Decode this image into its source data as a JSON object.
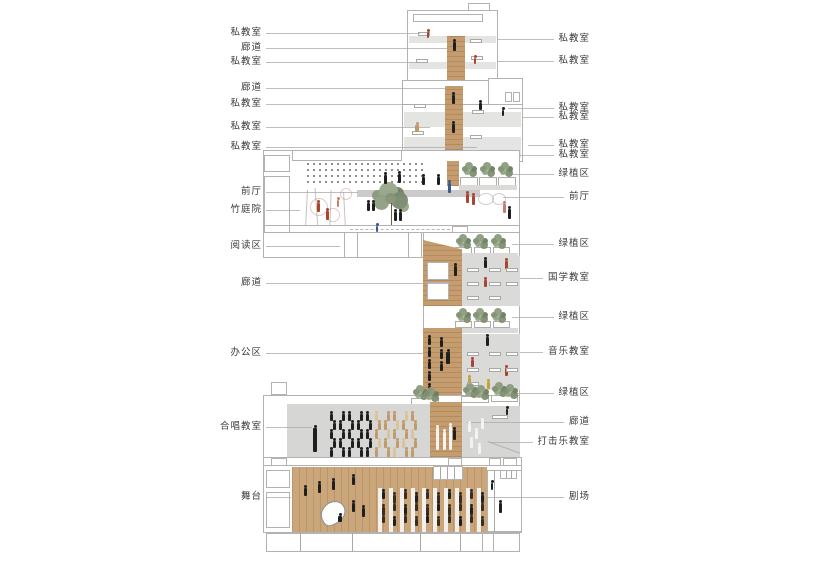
{
  "drawing": {
    "type": "architectural-section",
    "subject": "music school building section with room annotations"
  },
  "colors": {
    "wood": "#c59c6e",
    "room_gray": "#dadad9",
    "slab_gray": "#e4e4e3",
    "plant_green": "#7f9070",
    "outline": "#b3b2b0",
    "label_text": "#3b3b3b",
    "figure_red": "#a8452f",
    "figure_blue": "#3c5a8c",
    "figure_tan": "#c2996a"
  },
  "left_labels": [
    {
      "name": "private-classroom",
      "text": "私教室",
      "y": 33,
      "to": 420
    },
    {
      "name": "corridor",
      "text": "廊道",
      "y": 48,
      "to": 447
    },
    {
      "name": "private-classroom",
      "text": "私教室",
      "y": 62,
      "to": 420
    },
    {
      "name": "corridor",
      "text": "廊道",
      "y": 88,
      "to": 447
    },
    {
      "name": "private-classroom",
      "text": "私教室",
      "y": 104,
      "to": 418
    },
    {
      "name": "private-classroom",
      "text": "私教室",
      "y": 127,
      "to": 430
    },
    {
      "name": "private-classroom",
      "text": "私教室",
      "y": 147,
      "to": 477
    },
    {
      "name": "foyer",
      "text": "前厅",
      "y": 192,
      "to": 358
    },
    {
      "name": "bamboo-courtyard",
      "text": "竹庭院",
      "y": 210,
      "to": 300
    },
    {
      "name": "reading-area",
      "text": "阅读区",
      "y": 246,
      "to": 340
    },
    {
      "name": "corridor",
      "text": "廊道",
      "y": 283,
      "to": 455
    },
    {
      "name": "office-area",
      "text": "办公区",
      "y": 353,
      "to": 425
    },
    {
      "name": "choir-classroom",
      "text": "合唱教室",
      "y": 427,
      "to": 312
    },
    {
      "name": "stage",
      "text": "舞台",
      "y": 497,
      "to": 291
    }
  ],
  "right_labels": [
    {
      "name": "private-classroom",
      "text": "私教室",
      "y": 39,
      "from": 498
    },
    {
      "name": "private-classroom",
      "text": "私教室",
      "y": 61,
      "from": 498
    },
    {
      "name": "private-classroom",
      "text": "私教室",
      "y": 108,
      "from": 508
    },
    {
      "name": "private-classroom",
      "text": "私教室",
      "y": 117,
      "from": 523
    },
    {
      "name": "private-classroom",
      "text": "私教室",
      "y": 145,
      "from": 528
    },
    {
      "name": "private-classroom",
      "text": "私教室",
      "y": 155,
      "from": 520
    },
    {
      "name": "green-planting-area",
      "text": "绿植区",
      "y": 174,
      "from": 512
    },
    {
      "name": "foyer",
      "text": "前厅",
      "y": 197,
      "from": 503
    },
    {
      "name": "green-planting-area",
      "text": "绿植区",
      "y": 244,
      "from": 512
    },
    {
      "name": "chinese-studies-classroom",
      "text": "国学教室",
      "y": 278,
      "from": 520
    },
    {
      "name": "green-planting-area",
      "text": "绿植区",
      "y": 317,
      "from": 512
    },
    {
      "name": "music-classroom",
      "text": "音乐教室",
      "y": 352,
      "from": 520
    },
    {
      "name": "green-planting-area",
      "text": "绿植区",
      "y": 393,
      "from": 516
    },
    {
      "name": "corridor",
      "text": "廊道",
      "y": 422,
      "from": 467
    },
    {
      "name": "percussion-classroom",
      "text": "打击乐教室",
      "y": 442,
      "from": 490
    },
    {
      "name": "theater",
      "text": "剧场",
      "y": 497,
      "from": 487
    }
  ]
}
